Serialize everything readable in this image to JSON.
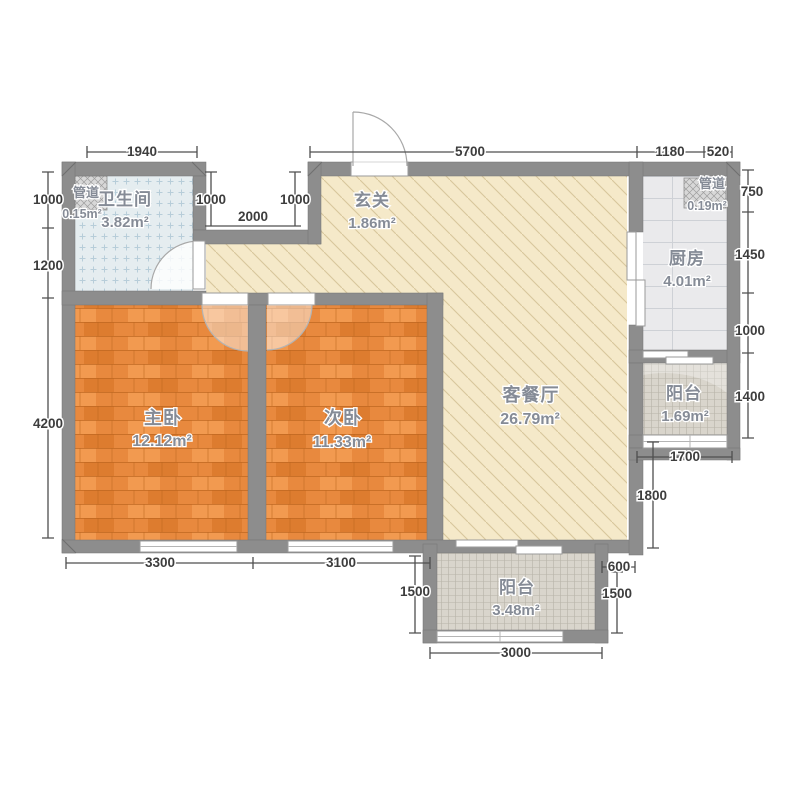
{
  "plan_type": "apartment-floor-plan",
  "rooms": {
    "duct_left": {
      "name": "管道",
      "area": "0.15m²"
    },
    "bathroom": {
      "name": "卫生间",
      "area": "3.82m²"
    },
    "entry": {
      "name": "玄关",
      "area": "1.86m²"
    },
    "duct_right": {
      "name": "管道",
      "area": "0.19m²"
    },
    "kitchen": {
      "name": "厨房",
      "area": "4.01m²"
    },
    "master_bedroom": {
      "name": "主卧",
      "area": "12.12m²"
    },
    "second_bedroom": {
      "name": "次卧",
      "area": "11.33m²"
    },
    "living_dining": {
      "name": "客餐厅",
      "area": "26.79m²"
    },
    "balcony_east": {
      "name": "阳台",
      "area": "1.69m²"
    },
    "balcony_south": {
      "name": "阳台",
      "area": "3.48m²"
    }
  },
  "dimensions": {
    "top": [
      "1940",
      "5700",
      "1180",
      "520"
    ],
    "left": [
      "1000",
      "1200",
      "4200"
    ],
    "right": [
      "750",
      "1450",
      "1000",
      "1400"
    ],
    "notch": [
      "1000",
      "1000",
      "2000"
    ],
    "bottom": [
      "3300",
      "3100"
    ],
    "east_wing": [
      "1700",
      "1800",
      "600"
    ],
    "south_balcony": [
      "1500",
      "3000",
      "1500"
    ]
  },
  "colors": {
    "wall": "#8d8d8d",
    "wood_floor": "#e8893e",
    "living_floor": "#f5e9c9",
    "bath_tile": "#e5edf0",
    "kitchen_tile": "#eaeaec",
    "balcony_tile": "#d9d5cc",
    "dim_text": "#3d3d3d",
    "room_text": "#858b96"
  }
}
